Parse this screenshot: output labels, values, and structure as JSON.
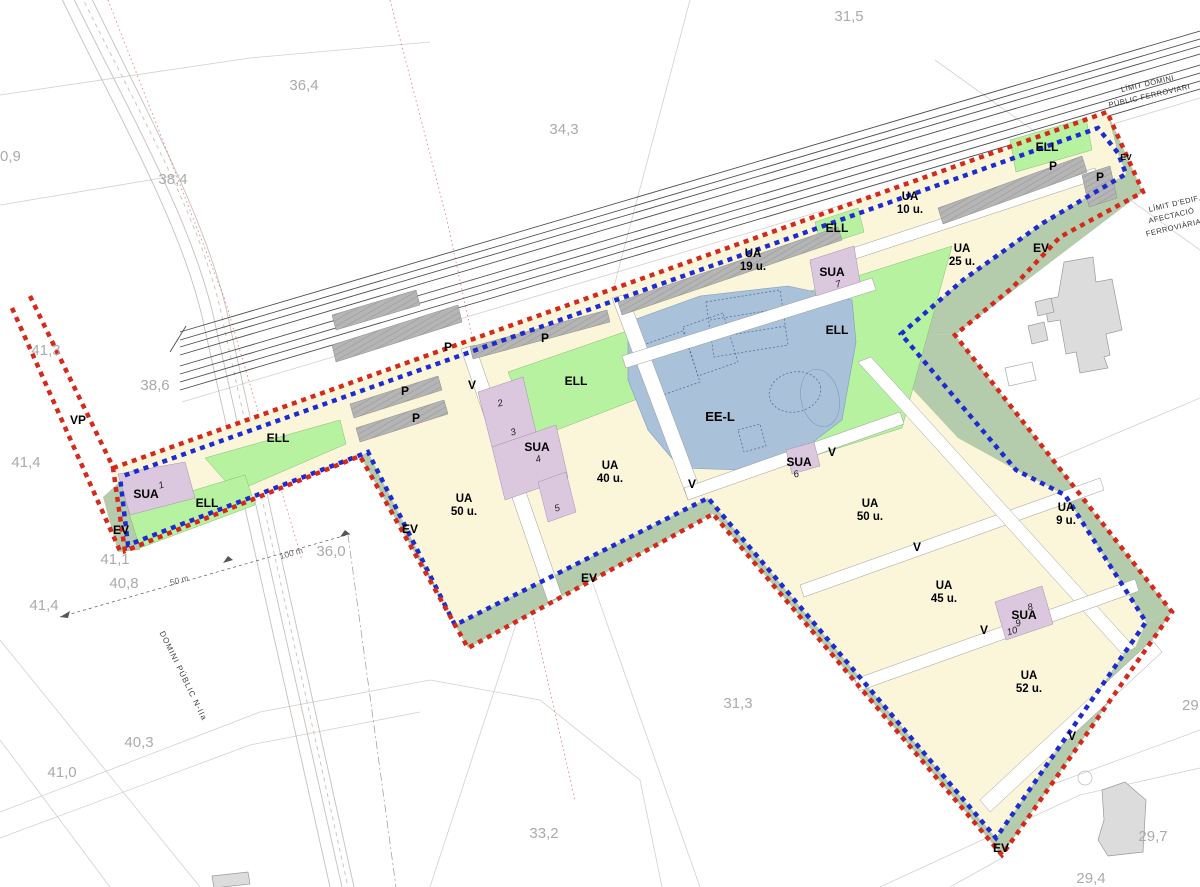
{
  "title": "Urban development plan — railway corridor sector",
  "texts": {
    "ell": "ELL",
    "p": "P",
    "v": "V",
    "ev": "EV",
    "vp": "VP",
    "sua": "SUA",
    "eel": "EE-L",
    "ua": "UA"
  },
  "ua_units": {
    "u9": "9 u.",
    "u10": "10 u.",
    "u19": "19 u.",
    "u25": "25 u.",
    "u40": "40 u.",
    "u45": "45 u.",
    "u50": "50 u.",
    "u52": "52 u."
  },
  "sua_nums": {
    "n1": "1",
    "n2": "2",
    "n3": "3",
    "n4": "4",
    "n5": "5",
    "n6": "6",
    "n7": "7",
    "n8": "8",
    "n9": "9",
    "n10": "10"
  },
  "limits": {
    "rail_domain_1": "LÍMIT DOMINI",
    "rail_domain_2": "PÚBLIC FERROVIARI",
    "rail_edif_1": "LÍMIT D'EDIF.",
    "rail_edif_2": "AFECTACIÓ",
    "rail_edif_3": "FERROVIÀRIA",
    "road_domain": "DOMINI PÚBLIC N-IIa"
  },
  "scale": {
    "s50": "50 m",
    "s100": "100 m"
  },
  "elevations": {
    "e31_5": "31,5",
    "e36_4": "36,4",
    "e34_3": "34,3",
    "e38_4": "38,4",
    "e0_9": "0,9",
    "e41_3": "41,3",
    "e38_6": "38,6",
    "e41_4a": "41,4",
    "e36_0": "36,0",
    "e41_1": "41,1",
    "e40_8": "40,8",
    "e41_4b": "41,4",
    "e40_3": "40,3",
    "e41_0": "41,0",
    "e31_3": "31,3",
    "e33_2": "33,2",
    "e29_7": "29,7",
    "e29_4": "29,4",
    "e29": "29"
  },
  "colors": {
    "boundary_red": "#d7281c",
    "boundary_blue": "#1e2bd2",
    "ua_cream": "#fbf6da",
    "ell_green": "#b7f2a0",
    "ev_sage": "#b4ccab",
    "p_gray": "#b5b5b5",
    "sua_mauve": "#dcc8de",
    "eel_blue": "#aac1da",
    "building_gray": "#dcdcdc",
    "elevation_gray": "#ababab"
  }
}
